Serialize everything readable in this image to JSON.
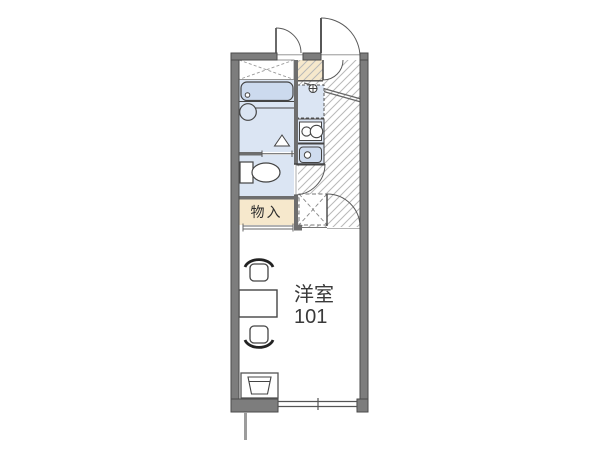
{
  "floor_plan": {
    "unit_label": {
      "room_type": "洋室",
      "room_number": "101"
    },
    "storage_label": "物入",
    "colors": {
      "wall_gray": "#7d7d7d",
      "wall_edge": "#4a4a4a",
      "fixture_blue": "#dbe5f3",
      "bathtub_blue": "#ccdaee",
      "tan_beige": "#f6e8cc",
      "hatch_gray": "#b8b8b8",
      "line_dark": "#444444",
      "text_color": "#333333",
      "background": "#ffffff"
    },
    "fixtures": [
      {
        "name": "entrance-door"
      },
      {
        "name": "utility-door"
      },
      {
        "name": "overhead-storage"
      },
      {
        "name": "bathtub"
      },
      {
        "name": "wash-basin"
      },
      {
        "name": "toilet"
      },
      {
        "name": "water-heater"
      },
      {
        "name": "refrigerator-space"
      },
      {
        "name": "gas-stove"
      },
      {
        "name": "kitchen-sink"
      },
      {
        "name": "washing-machine-space"
      },
      {
        "name": "entrance-step"
      },
      {
        "name": "room-door"
      },
      {
        "name": "toilet-door"
      },
      {
        "name": "storage-sliding-door"
      },
      {
        "name": "table"
      },
      {
        "name": "chair-top"
      },
      {
        "name": "chair-bottom"
      },
      {
        "name": "tv-stand"
      },
      {
        "name": "window"
      },
      {
        "name": "balcony-divider"
      }
    ]
  }
}
